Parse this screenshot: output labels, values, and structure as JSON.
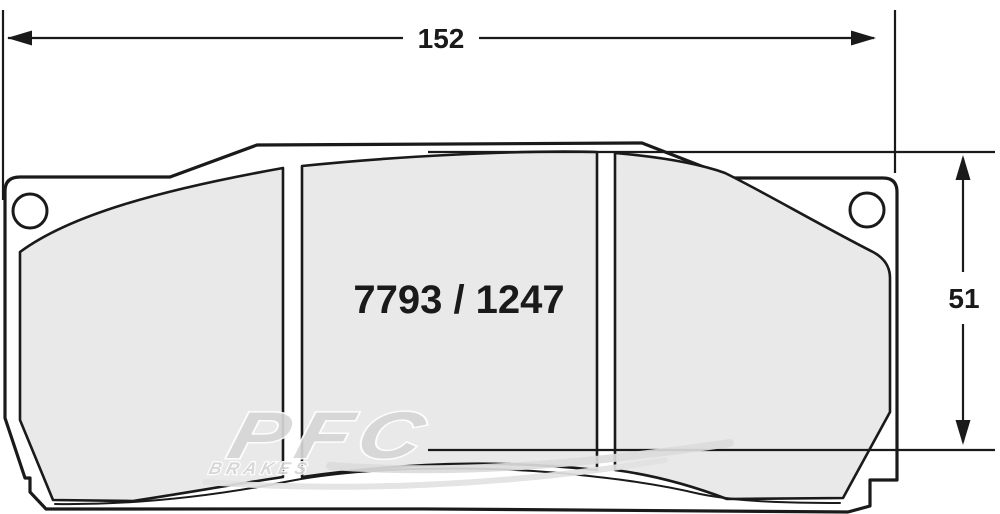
{
  "diagram": {
    "title": "brake-pad-technical-drawing",
    "part_number": "7793 / 1247",
    "width_mm": "152",
    "height_mm": "51"
  },
  "watermark": {
    "brand": "PFC",
    "sub_brand": "BRAKES"
  },
  "colors": {
    "line": "#1a1a1a",
    "pad_fill": "#e9e9e9",
    "background": "#ffffff",
    "watermark_gray": "#d6d6d6",
    "watermark_light": "#dedede"
  }
}
